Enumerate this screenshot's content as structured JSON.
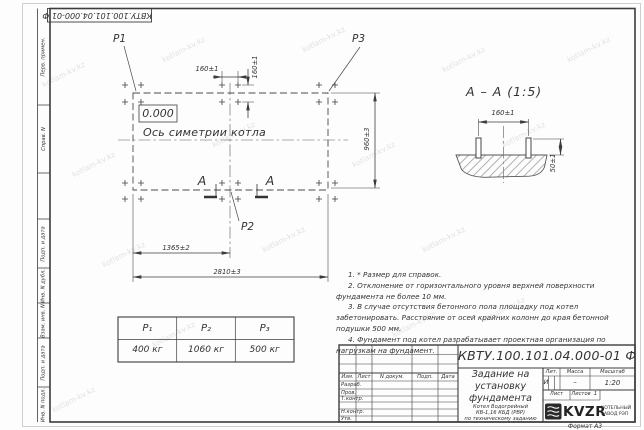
{
  "watermark": {
    "text": "kotlam-kv.kz"
  },
  "top_stamp": {
    "doc_number": "КВТУ.100.101.04.000-01  Ф"
  },
  "side_panel": {
    "fields": [
      "Перв. примен.",
      "Справ. N",
      "Подп. и дата",
      "Инв. N дубл.",
      "Взам. инв. N",
      "Подп. и дата",
      "Инв. N подл."
    ]
  },
  "plan": {
    "p1": "P1",
    "p2": "P2",
    "p3": "P3",
    "elevation": "0.000",
    "axis_label": "Ось симетрии котла",
    "section_letter_left": "А",
    "section_letter_right": "А",
    "dim_bolt_x": "160±1",
    "dim_bolt_y": "160±1",
    "dim_depth": "960±3",
    "dim_center": "1365±2",
    "dim_width": "2810±3"
  },
  "section": {
    "title": "А – А  (1:5)",
    "dim_spacing": "160±1",
    "dim_protrusion": "50±1"
  },
  "notes": {
    "items": [
      "1. * Размер для справок.",
      "2. Отклонение от горизонтального уровня верхней поверхности фундамента не более 10 мм.",
      "3. В случае отсутствия бетонного пола площадку под котел забетонировать. Расстояние от осей крайних колонн до края бетонной подушки 500 мм.",
      "4. Фундамент под котел разрабатывает проектная организация по нагрузкам на фундамент."
    ]
  },
  "load_table": {
    "headers": [
      "P₁",
      "P₂",
      "P₃"
    ],
    "values": [
      "400 кг",
      "1060 кг",
      "500 кг"
    ]
  },
  "title_block": {
    "doc_number": "КВТУ.100.101.04.000-01  Ф",
    "title_lines": [
      "Задание на",
      "установку",
      "фундамента"
    ],
    "subtitle_lines": [
      "Котел Водогрейный",
      "КВ-1,16  КБД  (РВР)",
      "по техническому заданию"
    ],
    "columns": [
      "Изм.",
      "Лист",
      "N докум.",
      "Подп.",
      "Дата"
    ],
    "rows": {
      "razrab": "Разраб.",
      "prov": "Пров.",
      "tkontr": "Т.контр.",
      "nkontr": "Н.контр.",
      "utv": "Утв."
    },
    "lit_label": "Лит.",
    "mass_label": "Масса",
    "scale_label": "Масштаб",
    "lit_value": "И",
    "mass_value": "–",
    "scale_value": "1:20",
    "sheet_label": "Лист",
    "sheets_label": "Листов",
    "sheets_value": "1",
    "logo_text": "KVZR",
    "company_lines": [
      "КОТЕЛЬНЫЙ",
      "ЗАВОД РЭП"
    ],
    "format_label": "Формат А3"
  }
}
